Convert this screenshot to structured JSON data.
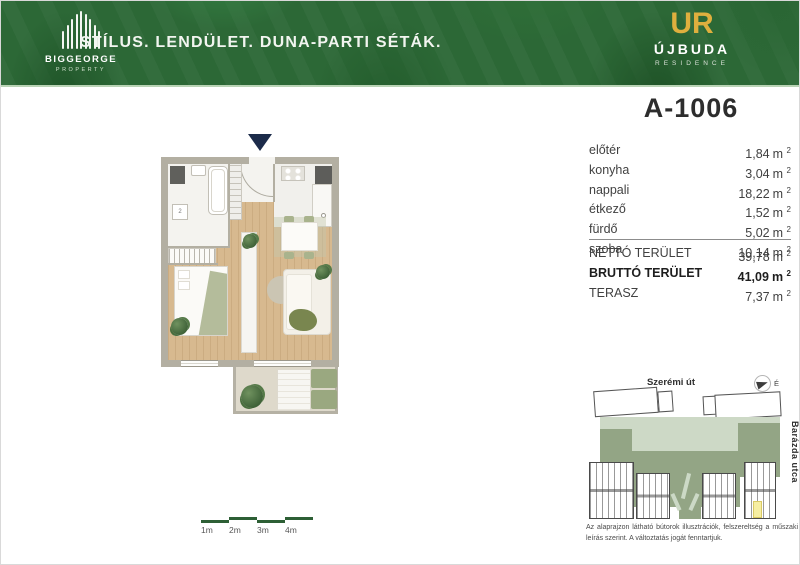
{
  "header": {
    "brand_name": "BIGGEORGE",
    "brand_subtitle": "PROPERTY",
    "headline": "STÍLUS. LENDÜLET. DUNA-PARTI SÉTÁK.",
    "logo_monogram": "UR",
    "logo_title": "ÚJBUDA",
    "logo_subtitle": "RESIDENCE"
  },
  "unit": {
    "title": "A-1006",
    "unit_symbol": "m",
    "unit_sup": "2",
    "plan_marker": "2",
    "rooms": [
      {
        "label": "előtér",
        "value": "1,84"
      },
      {
        "label": "konyha",
        "value": "3,04"
      },
      {
        "label": "nappali",
        "value": "18,22"
      },
      {
        "label": "étkező",
        "value": "1,52"
      },
      {
        "label": "fürdő",
        "value": "5,02"
      },
      {
        "label": "szoba",
        "value": "10,14"
      }
    ],
    "totals": [
      {
        "label": "NETTÓ TERÜLET",
        "value": "39,78"
      },
      {
        "label": "BRUTTÓ TERÜLET",
        "value": "41,09"
      },
      {
        "label": "TERASZ",
        "value": "7,37"
      }
    ]
  },
  "site_plan": {
    "street_top": "Szerémi út",
    "street_right": "Barázda utca",
    "north_label": "É"
  },
  "disclaimer": "Az alaprajzon látható bútorok illusztrációk, felszereltség a műszaki leírás szerint. A változtatás jogát fenntartjuk.",
  "scale_bar": {
    "labels": [
      "1m",
      "2m",
      "3m",
      "4m"
    ]
  },
  "colors": {
    "header_green": "#2c6836",
    "gold": "#dfaf3e",
    "entry_navy": "#1c2b4a",
    "wall_gray": "#b3afa2",
    "wood": "#d7b98f",
    "site_green_light": "#cdd9c6",
    "site_green": "#93a585",
    "highlight_yellow": "#f6eea2",
    "scale_green": "#2d5f35"
  }
}
